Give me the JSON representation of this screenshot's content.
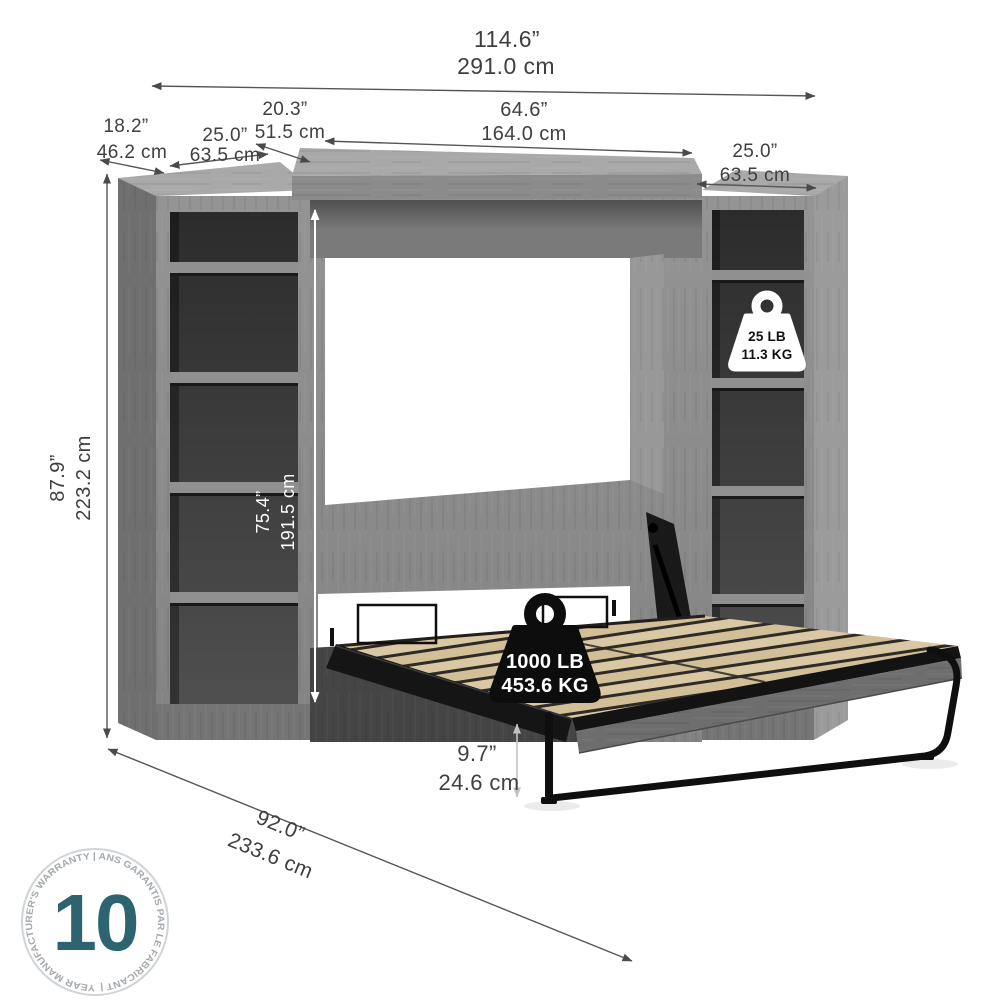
{
  "dims": {
    "overall_width": {
      "in": "114.6”",
      "cm": "291.0 cm"
    },
    "cabinet_depth": {
      "in": "20.3”",
      "cm": "51.5 cm"
    },
    "side_unit_depth": {
      "in": "18.2”",
      "cm": "46.2 cm"
    },
    "left_unit_width": {
      "in": "25.0”",
      "cm": "63.5 cm"
    },
    "cabinet_width": {
      "in": "64.6”",
      "cm": "164.0 cm"
    },
    "right_unit_width": {
      "in": "25.0”",
      "cm": "63.5 cm"
    },
    "overall_height": {
      "in": "87.9”",
      "cm": "223.2 cm"
    },
    "interior_height": {
      "in": "75.4”",
      "cm": "191.5 cm"
    },
    "floor_clearance": {
      "in": "9.7”",
      "cm": "24.6 cm"
    },
    "open_depth": {
      "in": "92.0”",
      "cm": "233.6 cm"
    }
  },
  "badges": {
    "shelf_capacity": {
      "lb": "25 LB",
      "kg": "11.3 KG"
    },
    "bed_capacity": {
      "lb": "1000 LB",
      "kg": "453.6 KG"
    }
  },
  "warranty": {
    "years": "10",
    "ring_text": "YEAR MANUFACTURER'S WARRANTY  |  ANS GARANTIS PAR LE FABRICANT  |"
  },
  "colors": {
    "wood_gray": "#8e8e8e",
    "wood_dark_interior": "#3a3a3a",
    "slat_tan": "#d9c7a2",
    "metal_black": "#141414",
    "warranty_teal": "#2d6470",
    "dimension_text": "#3f3f3f"
  }
}
